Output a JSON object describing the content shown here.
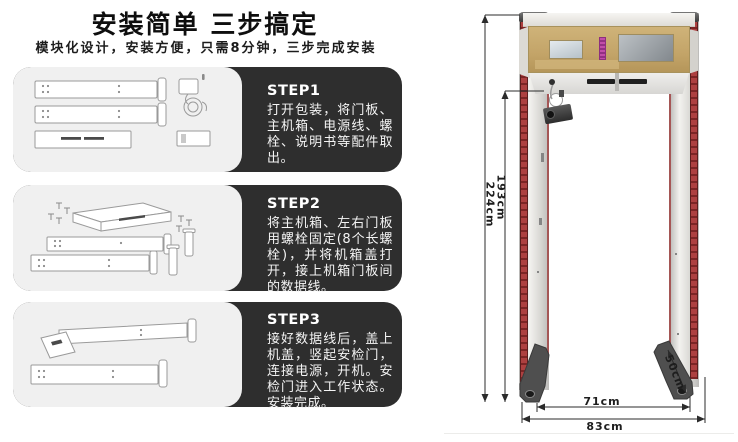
{
  "header": {
    "title": "安装简单 三步搞定",
    "subtitle": "模块化设计，安装方便，只需8分钟，三步完成安装"
  },
  "steps": [
    {
      "label": "STEP1",
      "text": "打开包装，将门板、主机箱、电源线、螺栓、说明书等配件取出。"
    },
    {
      "label": "STEP2",
      "text": "将主机箱、左右门板用螺栓固定(8个长螺栓)，并将机箱盖打开，接上机箱门板间的数据线。"
    },
    {
      "label": "STEP3",
      "text": "接好数据线后，盖上机盖，竖起安检门，连接电源，开机。安检门进入工作状态。安装完成。"
    }
  ],
  "product_diagram": {
    "dimensions": {
      "outer_height": "224cm",
      "inner_height": "193cm",
      "base_depth": "50cm",
      "inner_width": "71cm",
      "outer_width": "83cm"
    },
    "colors": {
      "led_strip_red": "#9c3434",
      "head_panel_tan": "#c3a468",
      "label_pink": "#b5399b",
      "step_box_dark": "#2e2e2e",
      "panel_light_gray": "#f0f0f0"
    }
  }
}
